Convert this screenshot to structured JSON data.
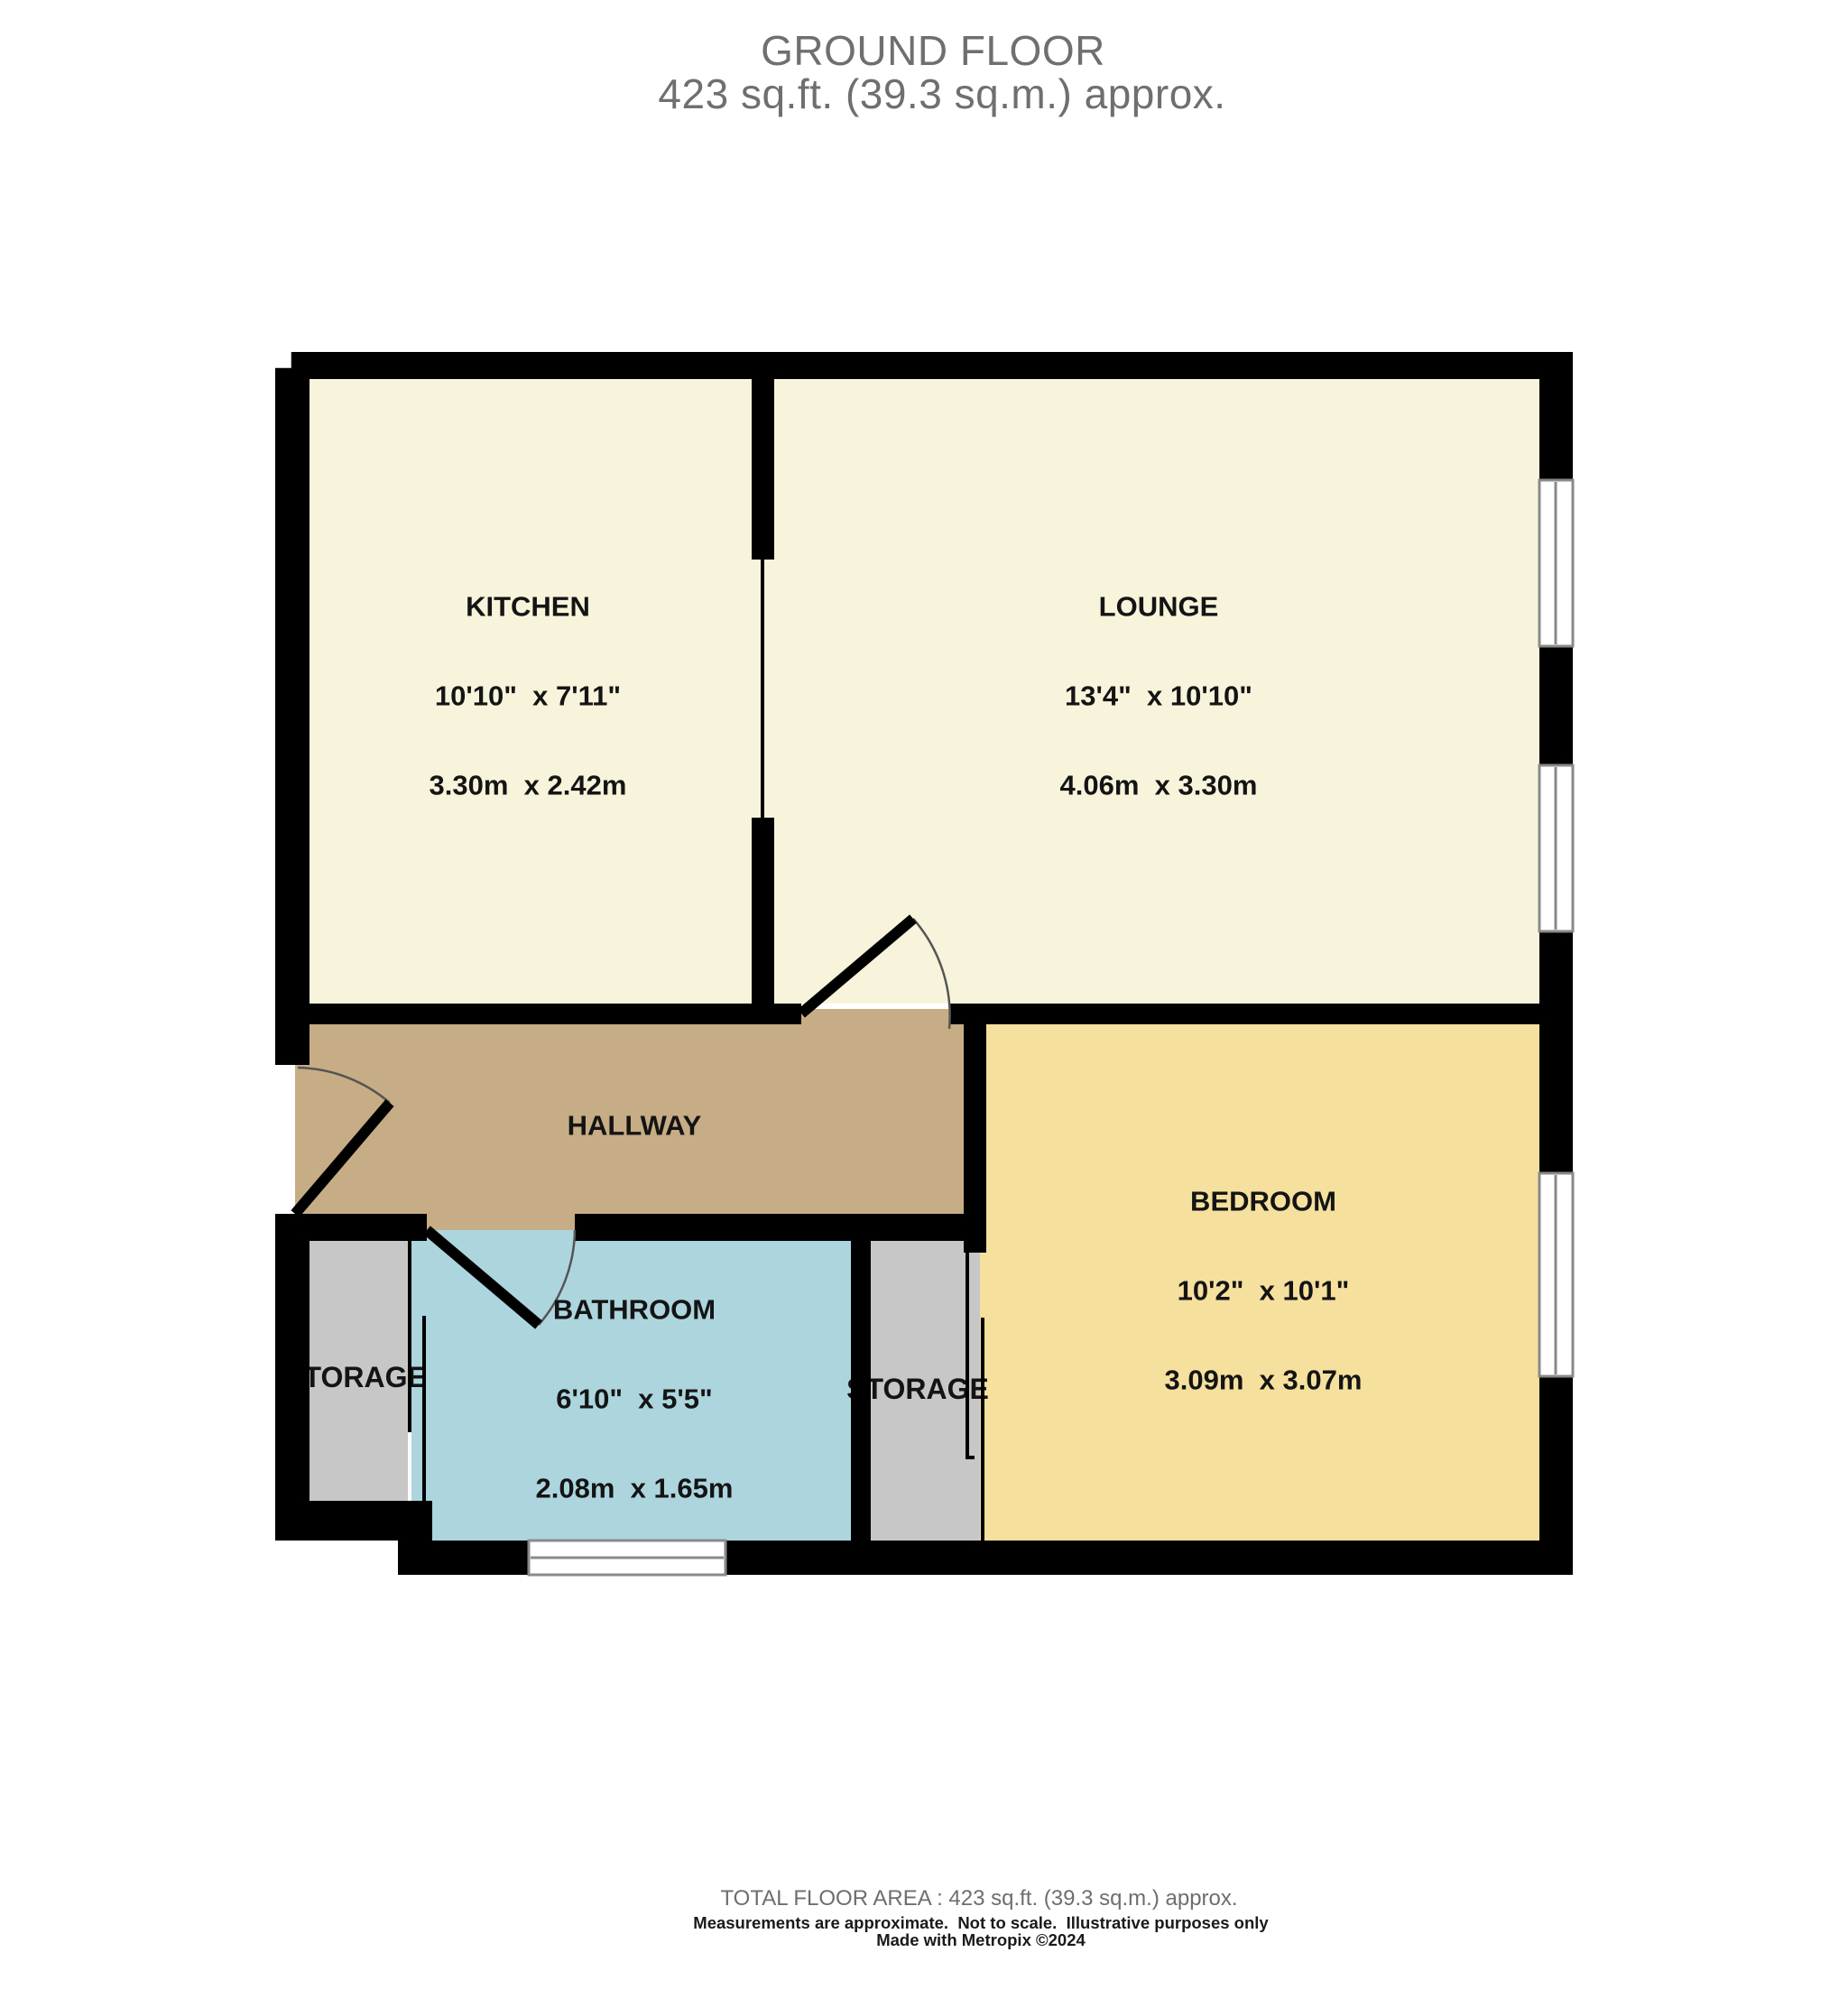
{
  "header": {
    "title": "GROUND FLOOR",
    "subtitle": "423 sq.ft. (39.3 sq.m.) approx."
  },
  "rooms": {
    "kitchen": {
      "name": "KITCHEN",
      "imperial": "10'10\"  x 7'11\"",
      "metric": "3.30m  x 2.42m"
    },
    "lounge": {
      "name": "LOUNGE",
      "imperial": "13'4\"  x 10'10\"",
      "metric": "4.06m  x 3.30m"
    },
    "bedroom": {
      "name": "BEDROOM",
      "imperial": "10'2\"  x 10'1\"",
      "metric": "3.09m  x 3.07m"
    },
    "bathroom": {
      "name": "BATHROOM",
      "imperial": "6'10\"  x 5'5\"",
      "metric": "2.08m  x 1.65m"
    },
    "hallway": {
      "name": "HALLWAY"
    },
    "storage_left": {
      "name": "STORAGE"
    },
    "storage_right": {
      "name": "STORAGE"
    }
  },
  "footer": {
    "total_area": "TOTAL FLOOR AREA : 423 sq.ft. (39.3 sq.m.) approx.",
    "disclaimer": "Measurements are approximate.  Not to scale.  Illustrative purposes only",
    "credit": "Made with Metropix ©2024"
  },
  "colors": {
    "wall": "#000000",
    "room_cream": "#F8F4DB",
    "room_yellow": "#F5E09E",
    "room_tan": "#C6AD85",
    "room_blue": "#ACD5DE",
    "room_gray": "#C7C7C7",
    "window_frame": "#8A8A8A",
    "door_arc": "#555555",
    "heading_gray": "#6F6F6F"
  }
}
